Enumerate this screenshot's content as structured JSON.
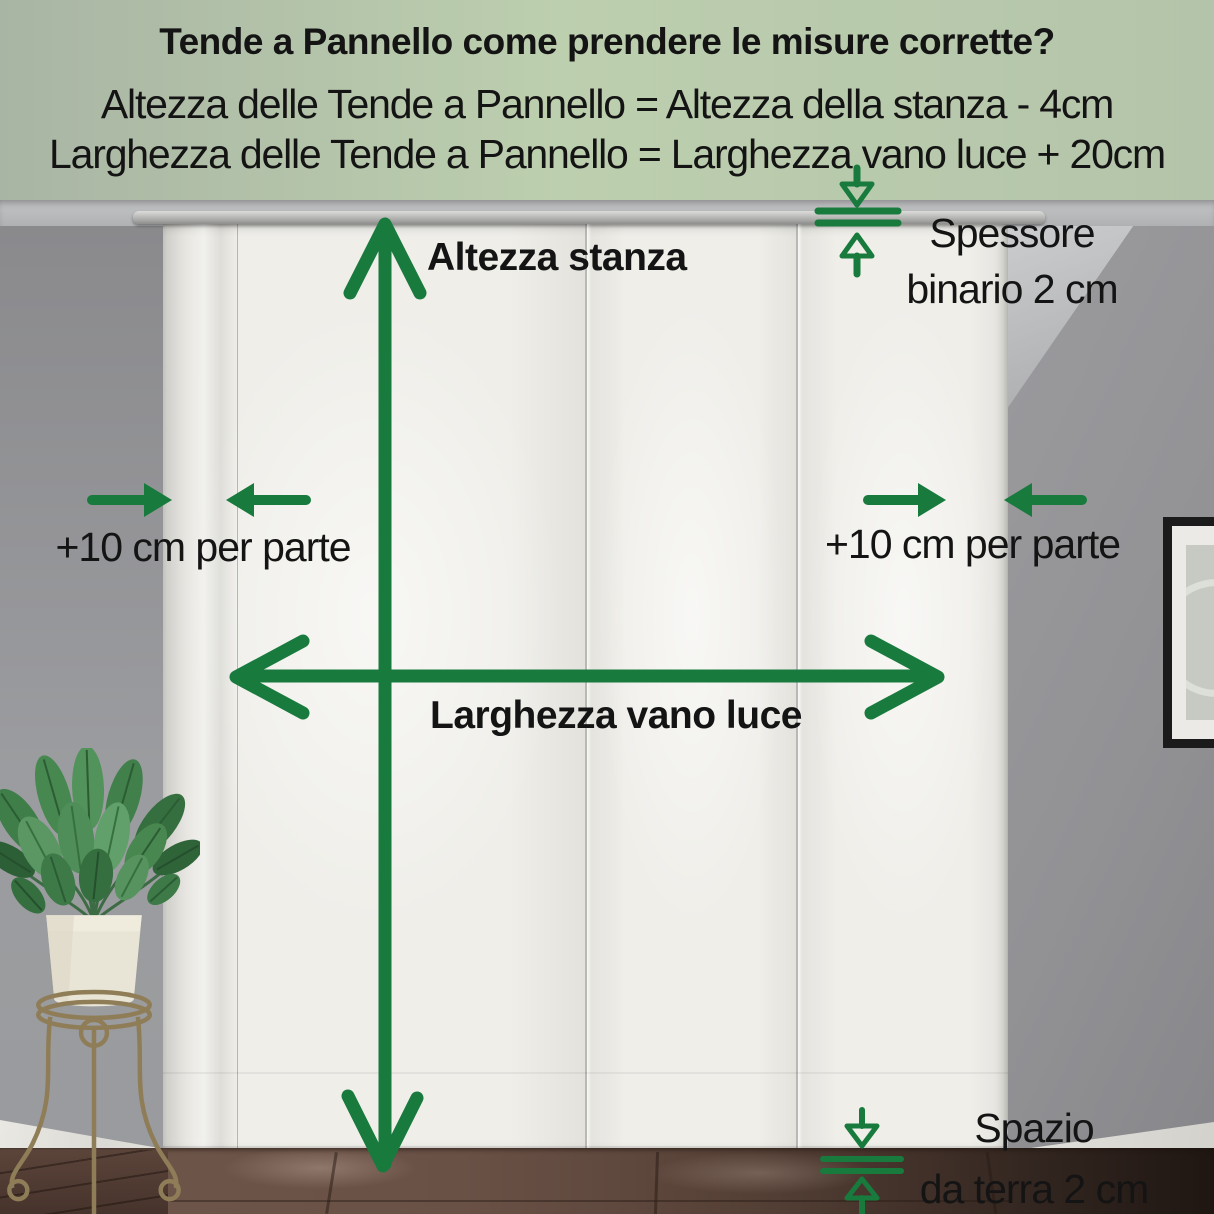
{
  "header": {
    "title": "Tende a Pannello come prendere le misure corrette?",
    "formula_height": "Altezza delle Tende a Pannello = Altezza della stanza - 4cm",
    "formula_width": "Larghezza delle Tende a Pannello = Larghezza vano luce + 20cm"
  },
  "annotations": {
    "room_height": "Altezza stanza",
    "opening_width": "Larghezza vano luce",
    "side_allowance_left": "+10 cm per parte",
    "side_allowance_right": "+10 cm per parte",
    "track_thickness_line1": "Spessore",
    "track_thickness_line2": "binario 2 cm",
    "floor_gap_line1": "Spazio",
    "floor_gap_line2": "da terra 2 cm"
  },
  "icons": {
    "vertical_measure": "double-headed-vertical-arrow",
    "horizontal_measure": "double-headed-horizontal-arrow",
    "side_offset_left": "converging-arrows",
    "side_offset_right": "converging-arrows",
    "track_thickness": "gap-gauge-arrows",
    "floor_gap": "gap-gauge-arrows"
  },
  "colors": {
    "annotation_green": "#187a3d",
    "header_background": "#bccfae",
    "text": "#141414"
  }
}
